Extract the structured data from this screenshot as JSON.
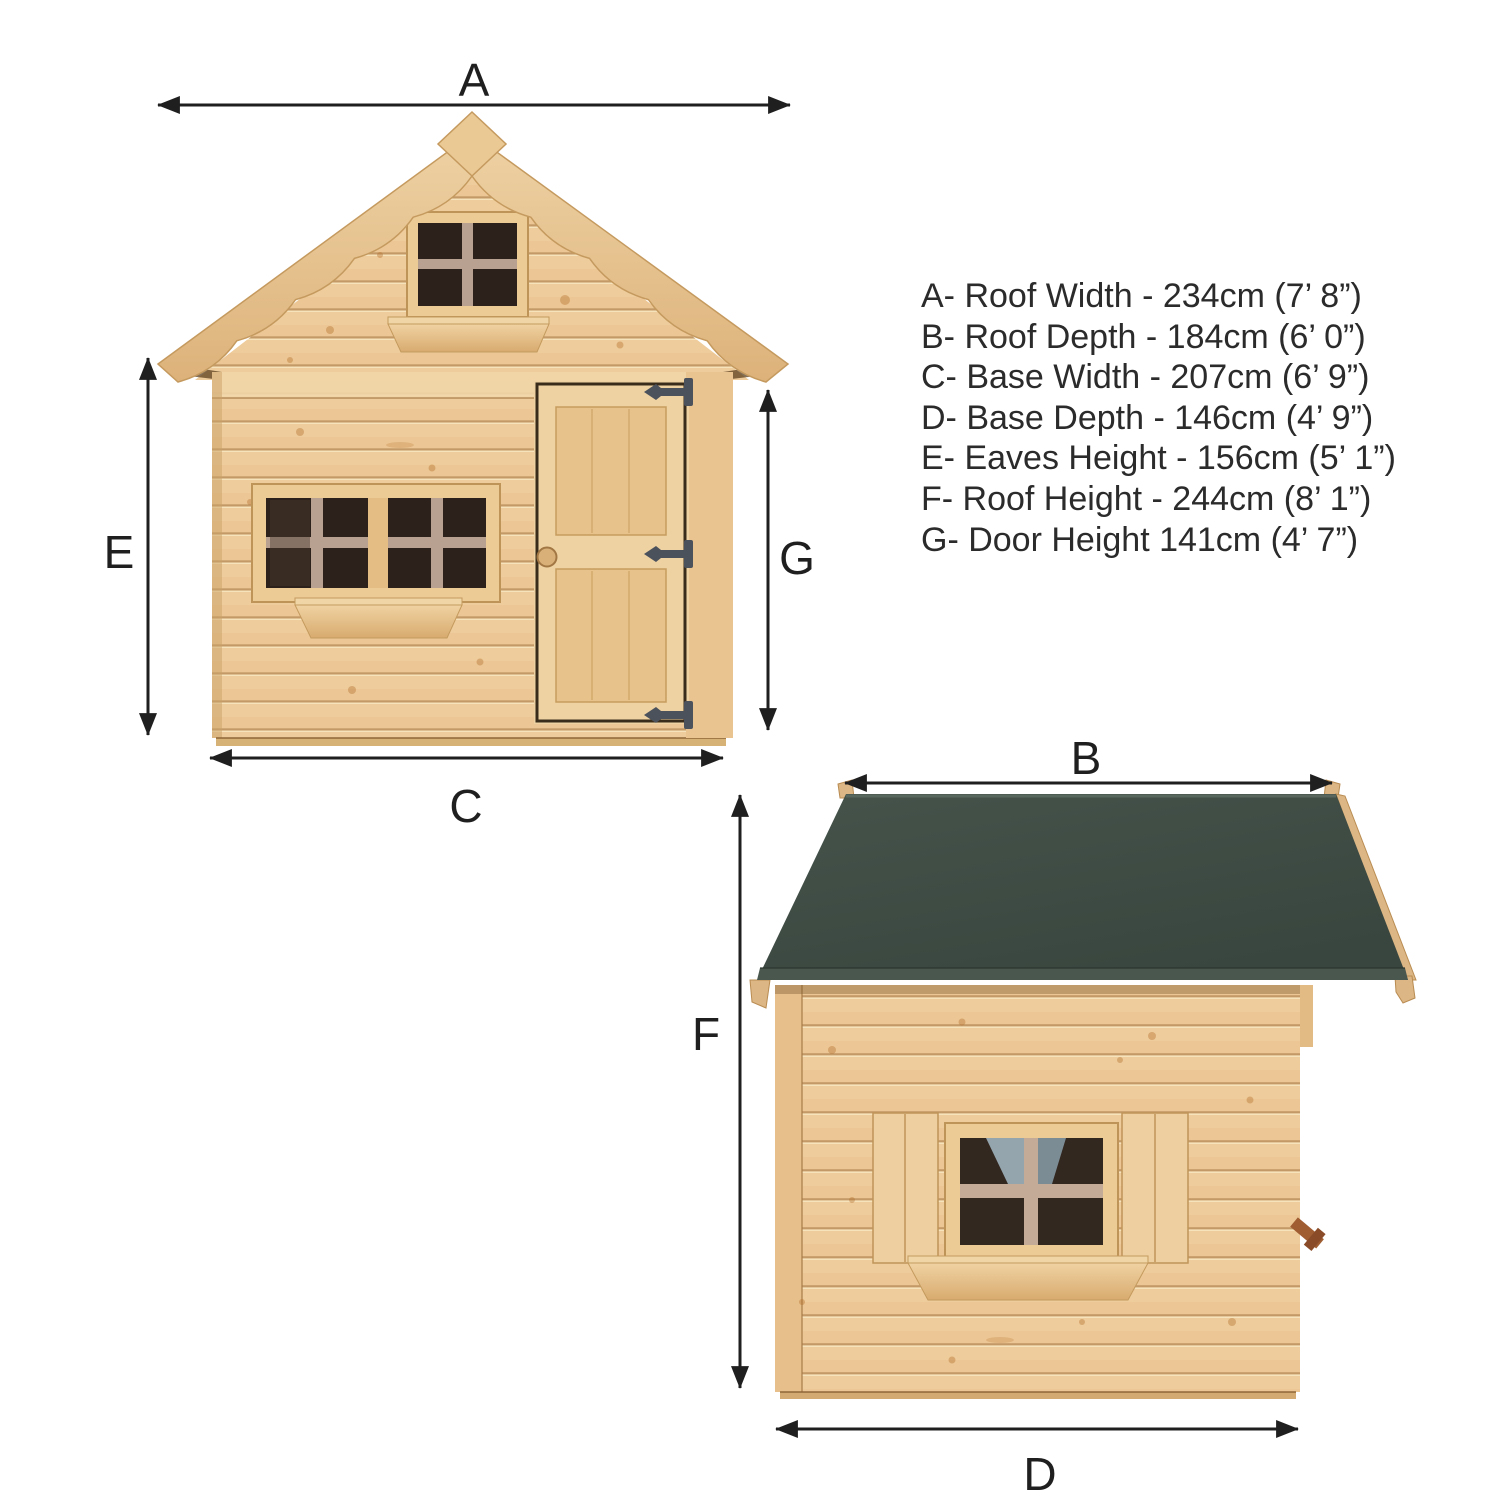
{
  "front_view": {
    "name": "front-elevation",
    "dimension_labels": {
      "roof_width": "A",
      "eaves_height": "E",
      "base_width": "C",
      "door_height": "G"
    }
  },
  "side_view": {
    "name": "side-elevation",
    "dimension_labels": {
      "roof_depth": "B",
      "roof_height": "F",
      "base_depth": "D"
    }
  },
  "legend": {
    "items": [
      "A- Roof Width - 234cm (7’ 8”)",
      "B- Roof Depth - 184cm (6’ 0”)",
      "C- Base Width - 207cm (6’ 9”)",
      "D- Base Depth - 146cm (4’ 9”)",
      "E- Eaves Height - 156cm (5’ 1”)",
      "F- Roof Height - 244cm (8’ 1”)",
      "G- Door Height 141cm (4’ 7”)"
    ]
  },
  "colors": {
    "wood": "#ecc795",
    "wood_dark": "#bf9459",
    "roof_felt": "#3f4d45",
    "window_pane": "#2c221b",
    "muntin": "#b8a191",
    "hinge": "#4c525c",
    "dimension_ink": "#1f1f1f",
    "legend_text": "#2b2b2b"
  }
}
